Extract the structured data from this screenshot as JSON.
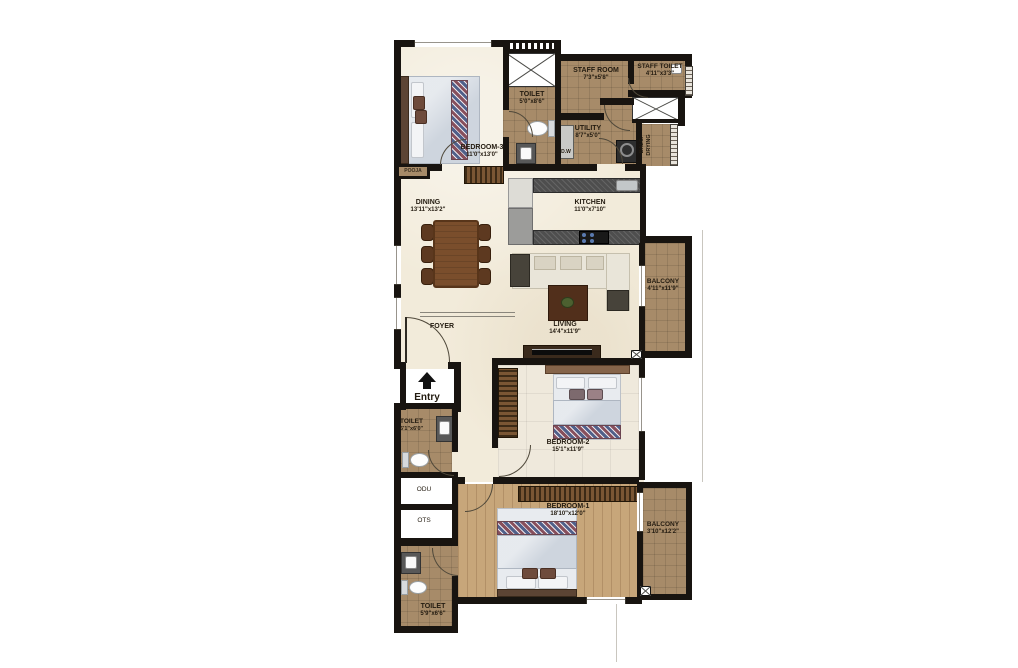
{
  "plan": {
    "rooms": {
      "bedroom3": {
        "name": "BEDROOM-3",
        "dims": "11'0\"x13'0\""
      },
      "toilet_top": {
        "name": "TOILET",
        "dims": "5'0\"x8'6\""
      },
      "staff_room": {
        "name": "STAFF ROOM",
        "dims": "7'3\"x5'8\""
      },
      "staff_toilet": {
        "name": "STAFF TOILET",
        "dims": "4'11\"x3'3\""
      },
      "utility": {
        "name": "UTILITY",
        "dims": "8'7\"x5'0\""
      },
      "balc_drying": {
        "name": "BALC. DRYING",
        "dims": ""
      },
      "pooja": {
        "name": "POOJA",
        "dims": ""
      },
      "dining": {
        "name": "DINING",
        "dims": "13'11\"x13'2\""
      },
      "kitchen": {
        "name": "KITCHEN",
        "dims": "11'0\"x7'10\""
      },
      "living": {
        "name": "LIVING",
        "dims": "14'4\"x11'9\""
      },
      "balcony_living": {
        "name": "BALCONY",
        "dims": "4'11\"x11'9\""
      },
      "foyer": {
        "name": "FOYER",
        "dims": ""
      },
      "entry": {
        "name": "Entry",
        "dims": ""
      },
      "toilet_mid": {
        "name": "TOILET",
        "dims": "6'1\"x6'0\""
      },
      "odu": {
        "name": "ODU",
        "dims": ""
      },
      "ots": {
        "name": "OTS",
        "dims": ""
      },
      "bedroom2": {
        "name": "BEDROOM-2",
        "dims": "15'1\"x11'9\""
      },
      "bedroom1": {
        "name": "BEDROOM-1",
        "dims": "18'10\"x12'0\""
      },
      "balcony_bedroom1": {
        "name": "BALCONY",
        "dims": "3'10\"x12'2\""
      },
      "toilet_bottom": {
        "name": "TOILET",
        "dims": "5'9\"x6'6\""
      },
      "dw": {
        "name": "D.W",
        "dims": ""
      }
    },
    "colors": {
      "wall": "#181410",
      "tile": "#a78b69",
      "cream": "#f2ebda",
      "wood": "#c7a67a",
      "bed": "#ced5de"
    }
  }
}
